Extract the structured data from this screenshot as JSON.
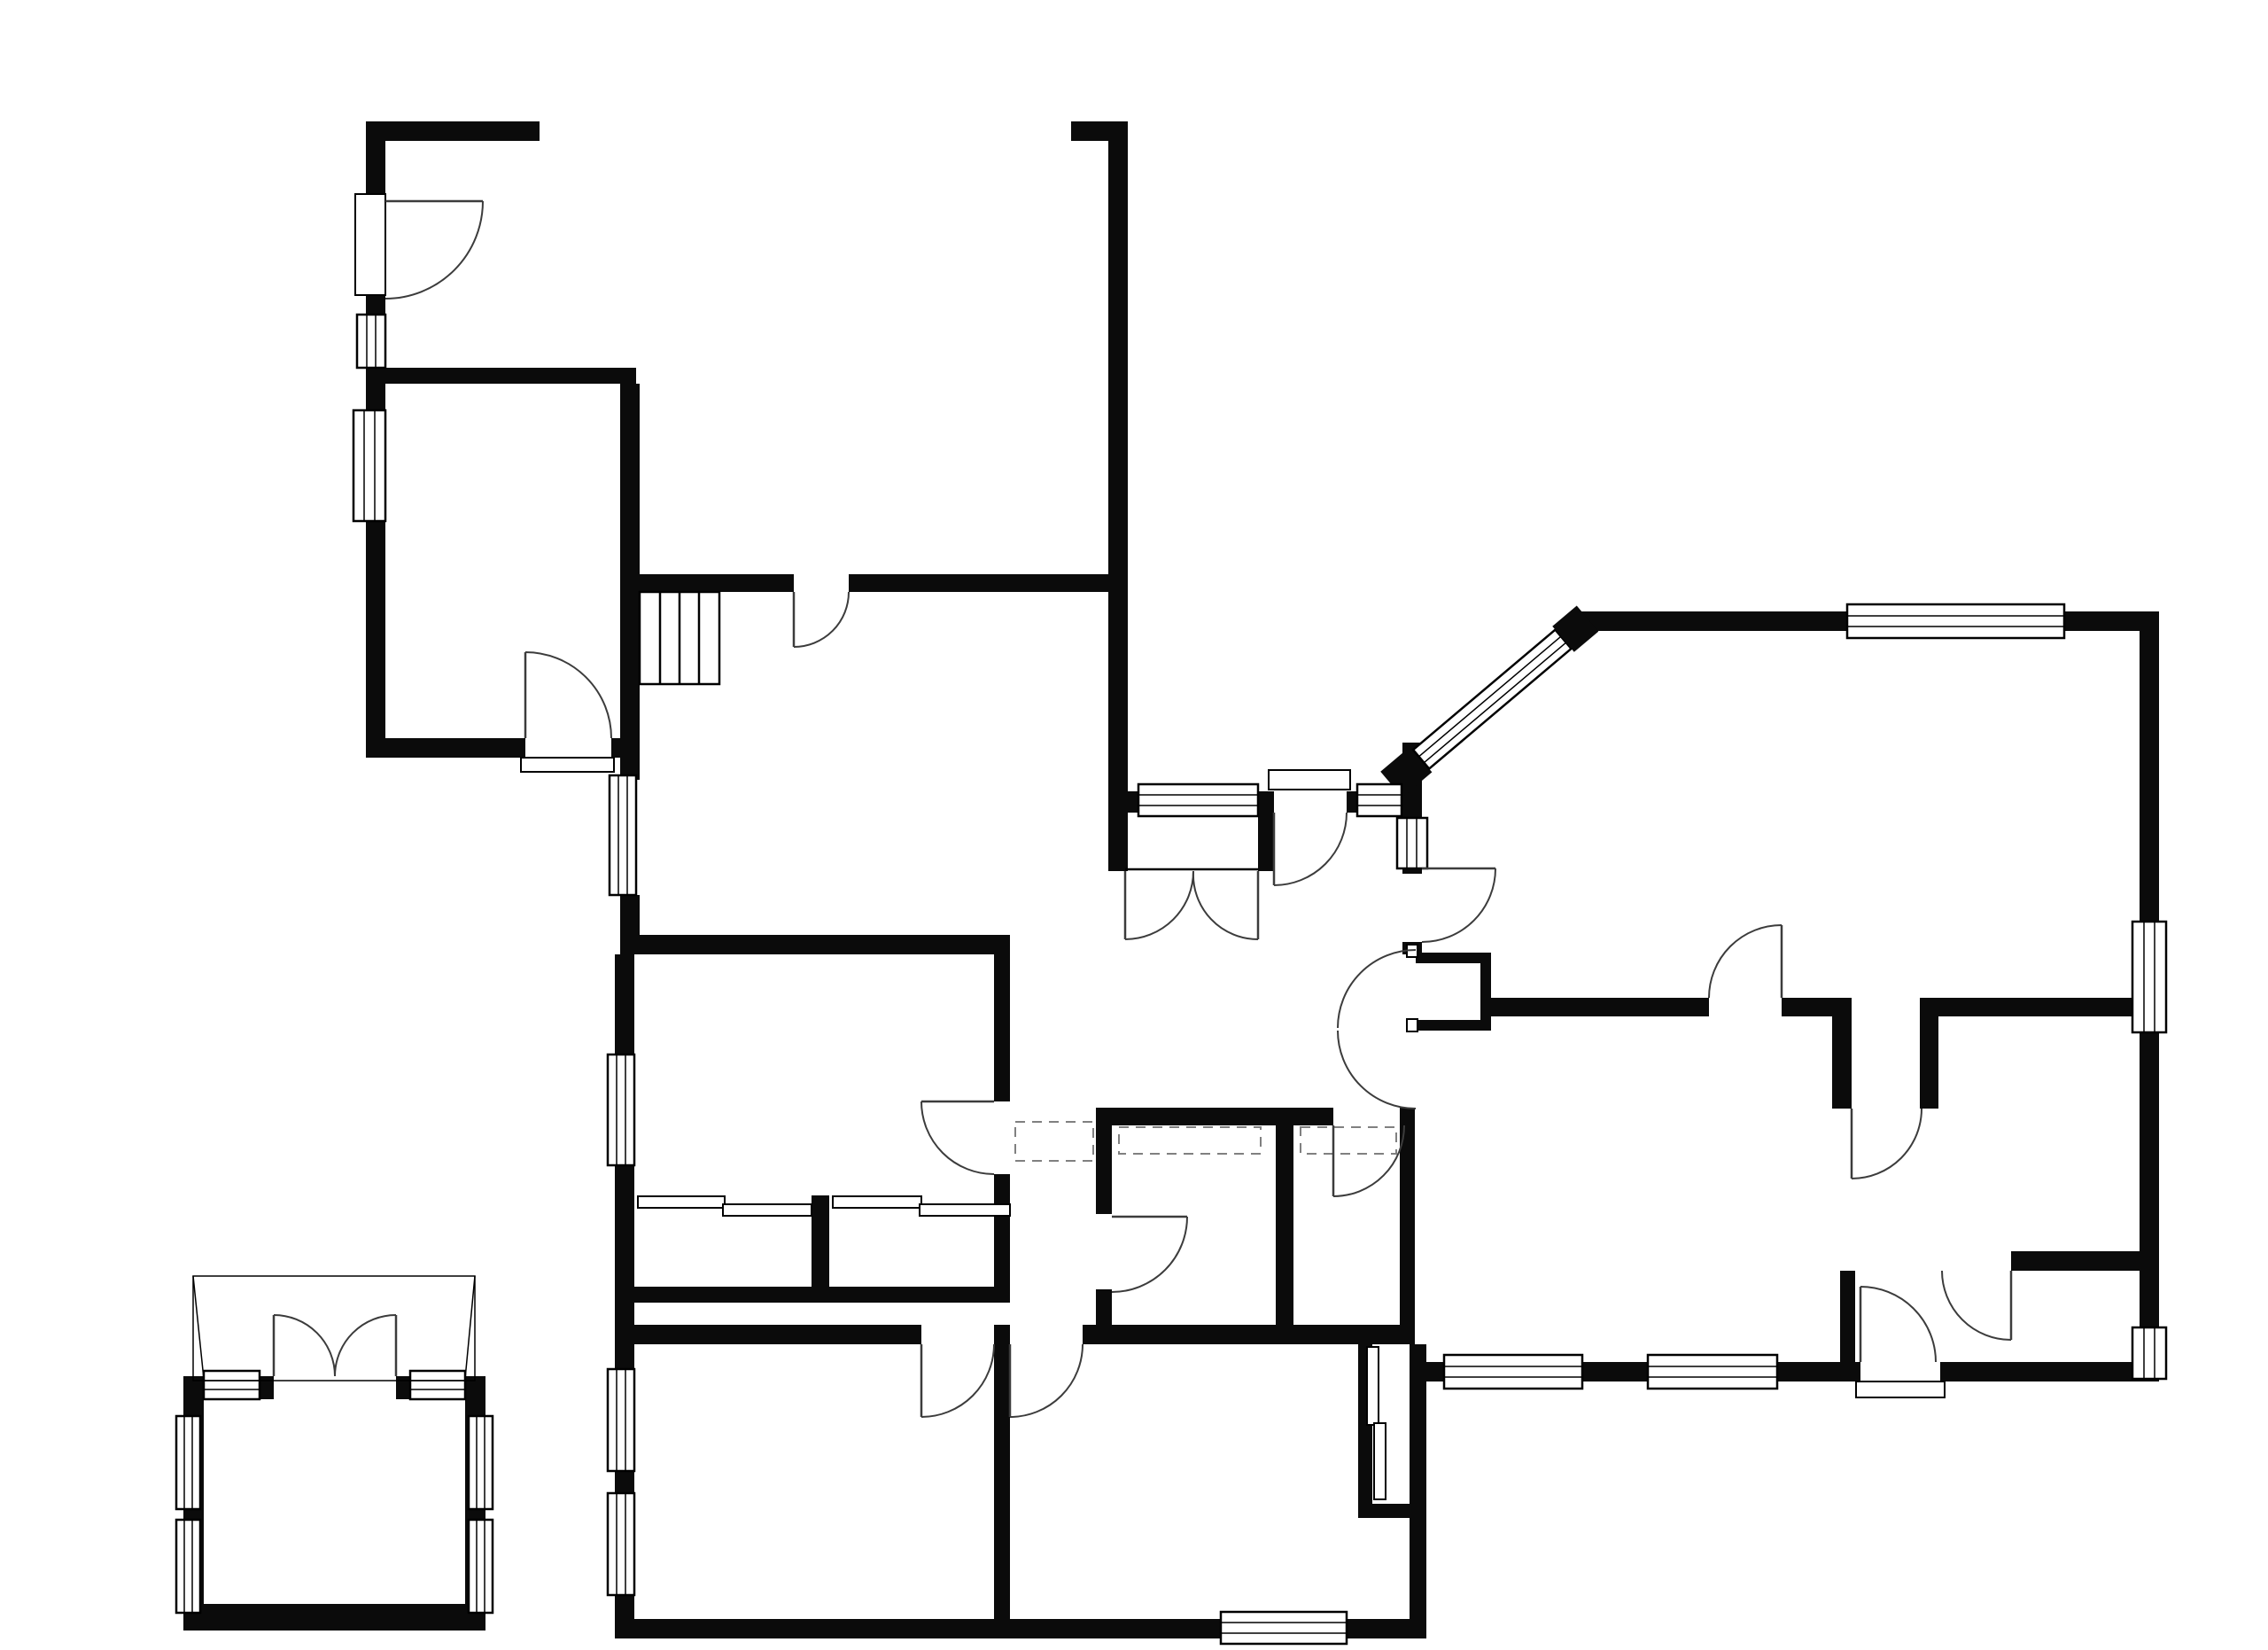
{
  "title": "Floor Plan",
  "rooms": {
    "workshop": {
      "name": "Workshop"
    },
    "double_garage": {
      "name_line1": "Double",
      "name_line2": "Garage",
      "dim_m": "5.16m x 4.75m",
      "dim_ft": "(16'11\" x 15'7\")"
    },
    "office": {
      "name": "Office",
      "dim_m": "4.07m x 2.50m",
      "dim_ft": "(13'4\" x 8'2\")"
    },
    "dining_room": {
      "name_line1": "Dining",
      "name_line2": "Room",
      "dim_m": "5.16m (16'11\")",
      "dim_ft": "x 3.82m (12'6\") max"
    },
    "lounge": {
      "name": "Lounge",
      "dim_m": "7.01m (23')",
      "dim_ft": "x 4.36m (14'4\") max"
    },
    "hall": {
      "name": "Hall"
    },
    "bedroom3": {
      "name": "Bedroom 3",
      "dim_m": "3.90m x 2.45m",
      "dim_ft": "(12'10\" x 8'1\")"
    },
    "bathroom": {
      "name": "Bathroom",
      "dim_m": "2.25m x 1.90m",
      "dim_ft": "(7'4\" x 6'3\")"
    },
    "shower_room": {
      "name_line1": "Shower",
      "name_line2": "Room",
      "dim_m": "2.25m x 1.31m",
      "dim_ft": "(7'4\" x 4'3\")"
    },
    "dining_kitchen": {
      "name_line1": "Dining",
      "name_line2": "Kitchen"
    },
    "utility_room": {
      "name_line1": "Utility",
      "name_line2": "Room",
      "dim_m": "2.43m x 2.23m",
      "dim_ft": "(8' x 7'4\")"
    },
    "wc": {
      "name": "WC"
    },
    "bedroom1": {
      "name": "Bedroom 1",
      "dim_m": "3.99m x 3.90m",
      "dim_ft": "(13'1\" x 12'10\")"
    },
    "bedroom2": {
      "name": "Bedroom 2",
      "dim_m": "3.84m x 3.06m",
      "dim_ft": "(12'7\" x 10')"
    },
    "summer_cabin": {
      "name_line1": "Summer",
      "name_line2": "Cabin"
    }
  },
  "markers": {
    "closet": "C",
    "wardrobe": "W"
  }
}
